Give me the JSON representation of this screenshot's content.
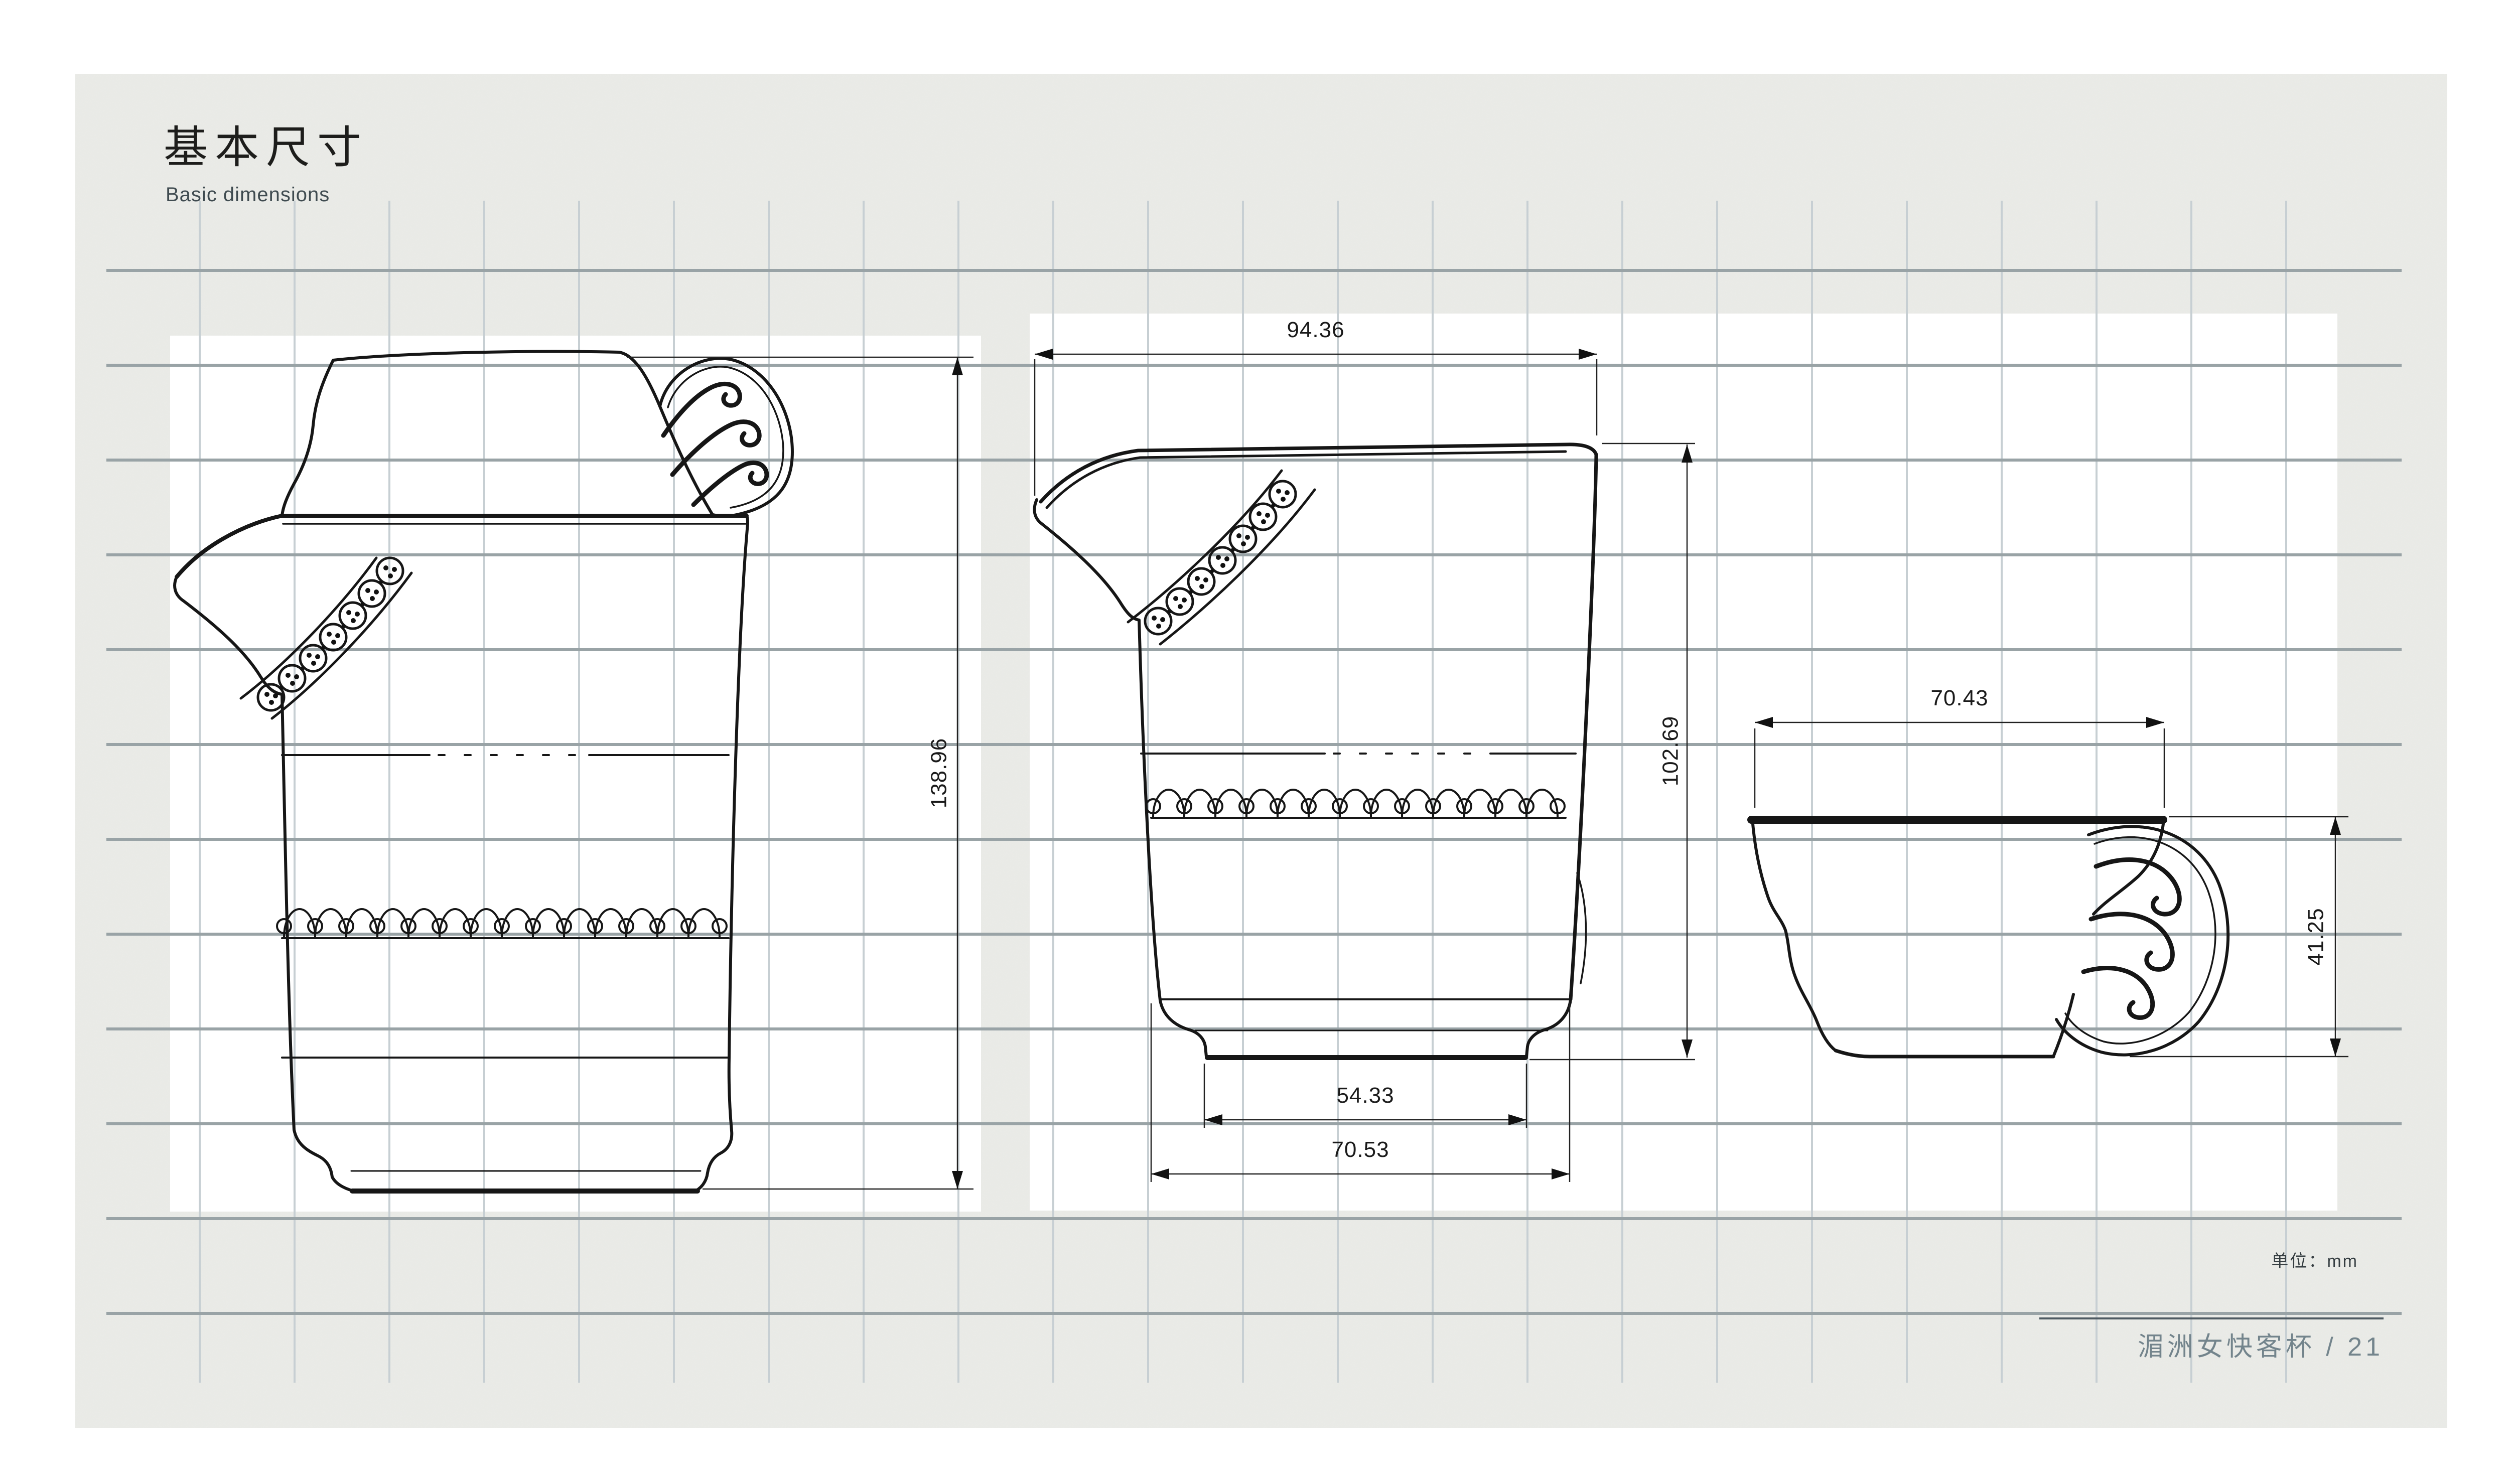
{
  "header": {
    "title": "基本尺寸",
    "subtitle": "Basic dimensions"
  },
  "dims": {
    "assembled_height": "138.96",
    "pot_top_width": "94.36",
    "pot_height": "102.69",
    "pot_foot_width": "54.33",
    "pot_base_width": "70.53",
    "cup_top_width": "70.43",
    "cup_height": "41.25"
  },
  "footer": {
    "unit_label": "单位：mm",
    "caption": "湄洲女快客杯 / 21"
  },
  "colors": {
    "paper": "#ebece8",
    "grid_vertical": "#c7cfd3",
    "grid_horizontal": "#99a3a6",
    "ink": "#161616",
    "caption_text": "#73848c"
  }
}
